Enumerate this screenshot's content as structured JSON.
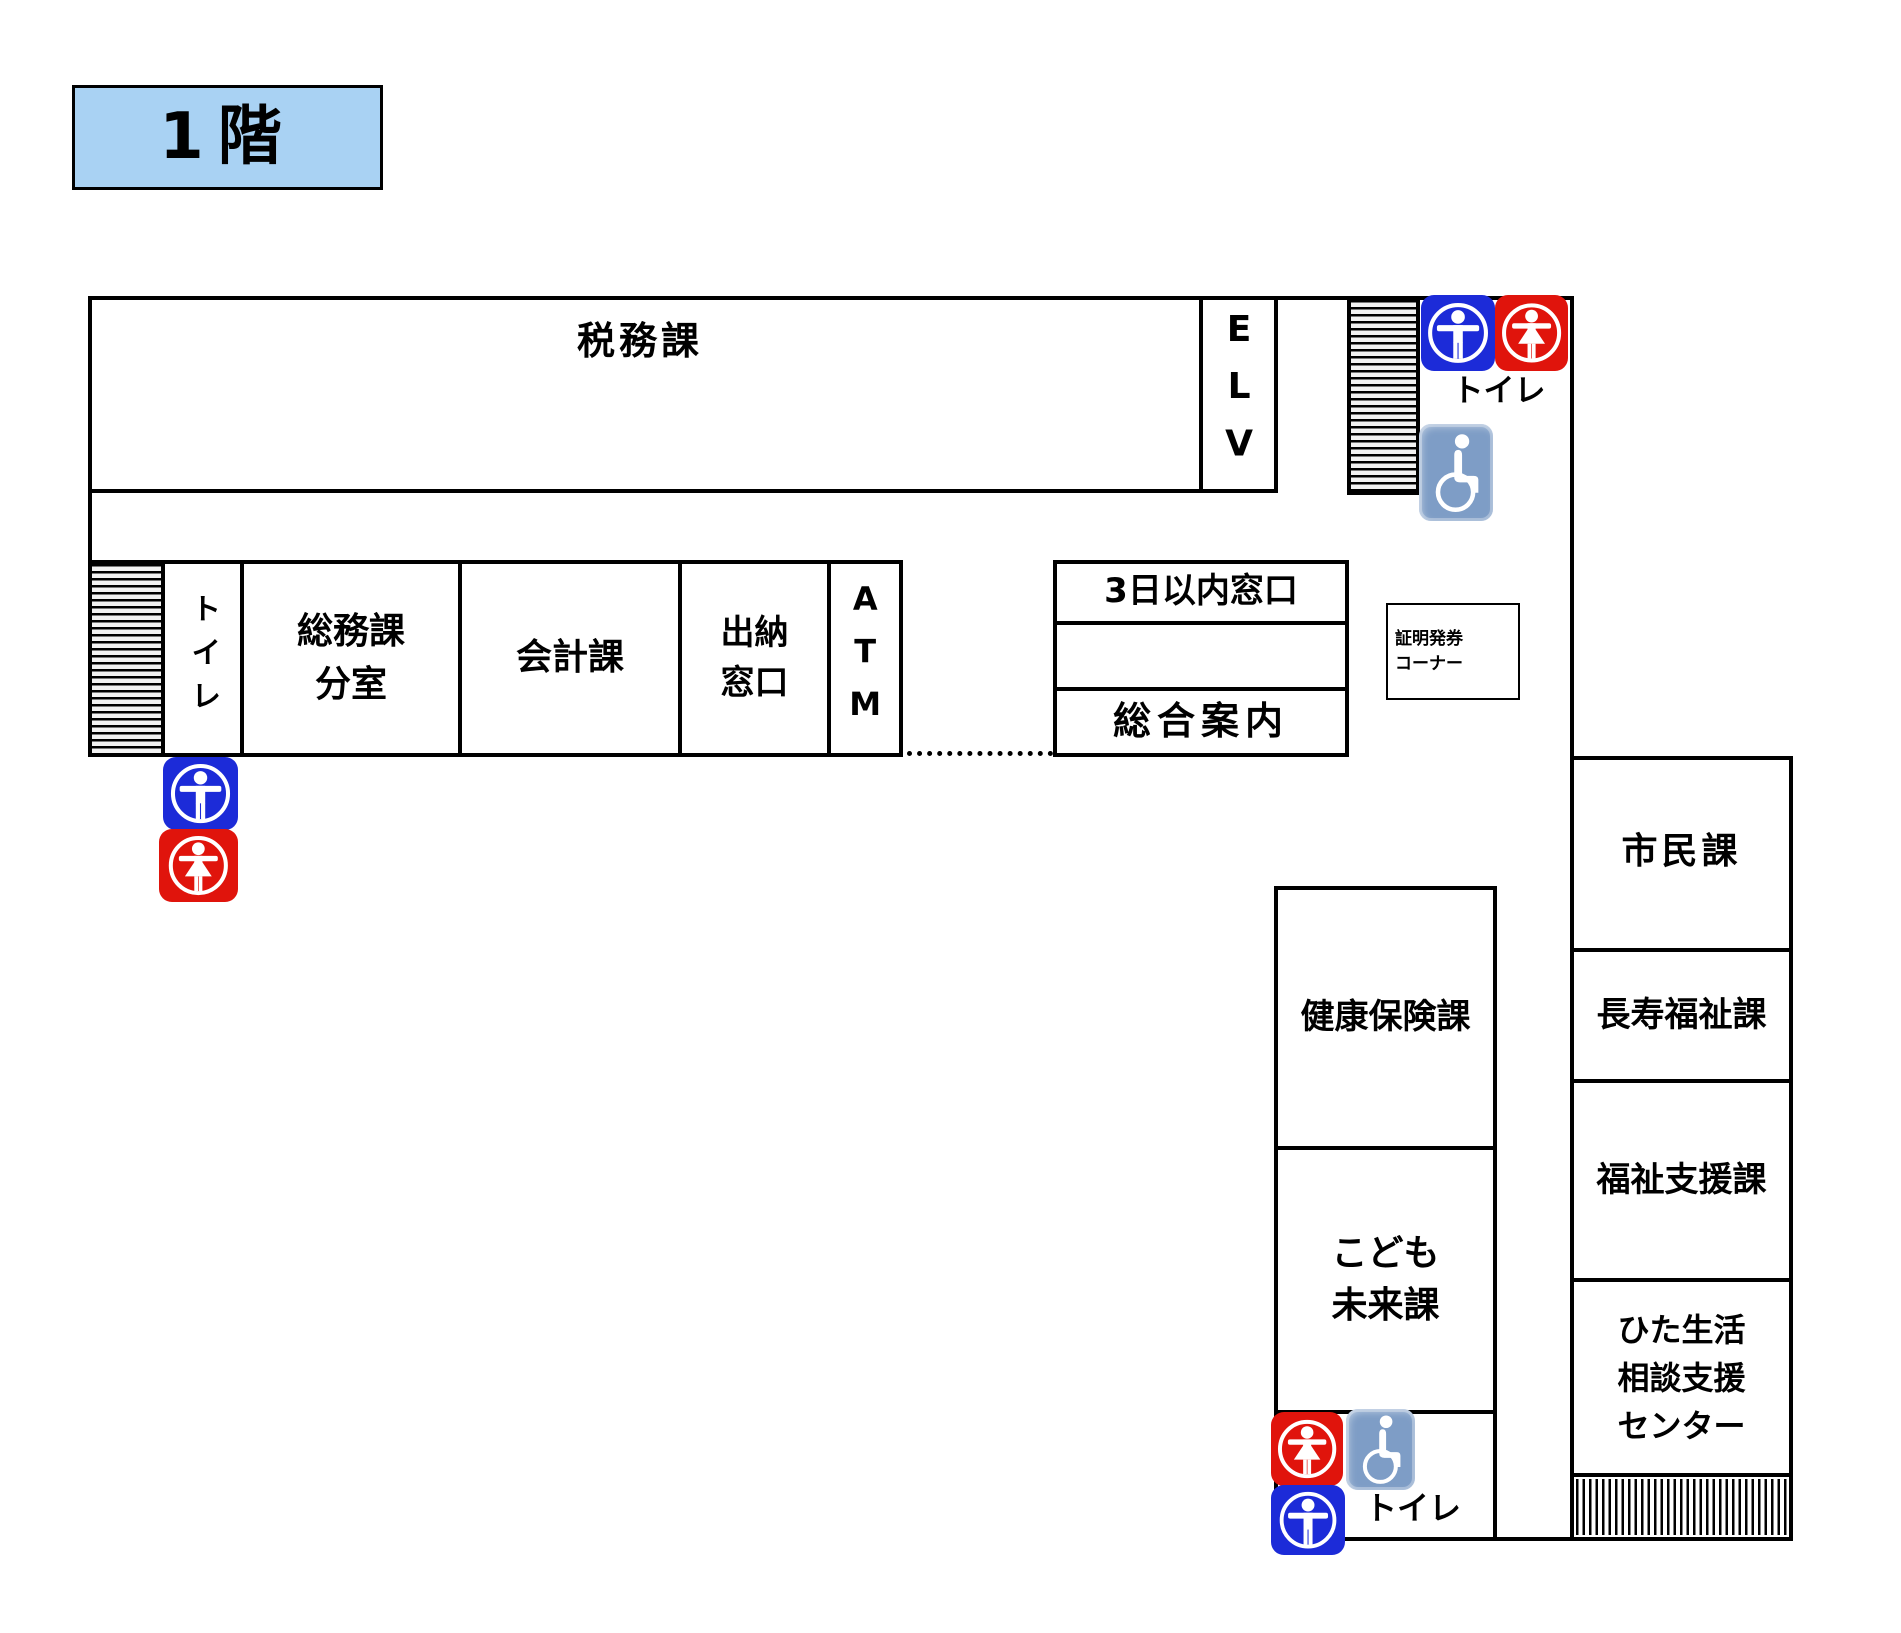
{
  "floor": {
    "label": "1階"
  },
  "colors": {
    "floor_box_bg": "#a9d2f3",
    "male_icon": "#1c2bd8",
    "female_icon": "#e0140c",
    "wheelchair_icon": "#7e9dc6"
  },
  "rooms": {
    "tax_division": "税務課",
    "elevator": "ELV",
    "toilet_left_room": "トイレ",
    "general_affairs_annex": "総務課\n分室",
    "accounting": "会計課",
    "cashier_window": "出納\n窓口",
    "atm": "ATM",
    "three_day_window": "3日以内窓口",
    "general_information": "総合案内",
    "certificate_corner": "証明発券\nコーナー",
    "health_insurance": "健康保険課",
    "children_future": "こども\n未来課",
    "citizens": "市民課",
    "longevity_welfare": "長寿福祉課",
    "welfare_support": "福祉支援課",
    "hita_life_support_center": "ひた生活\n相談支援\nセンター"
  },
  "labels": {
    "toilet_top": "トイレ",
    "toilet_bottom": "トイレ"
  },
  "icons": {
    "male_restroom": "male-restroom-icon",
    "female_restroom": "female-restroom-icon",
    "wheelchair": "wheelchair-accessible-icon",
    "stairs": "stairs-hatch"
  }
}
